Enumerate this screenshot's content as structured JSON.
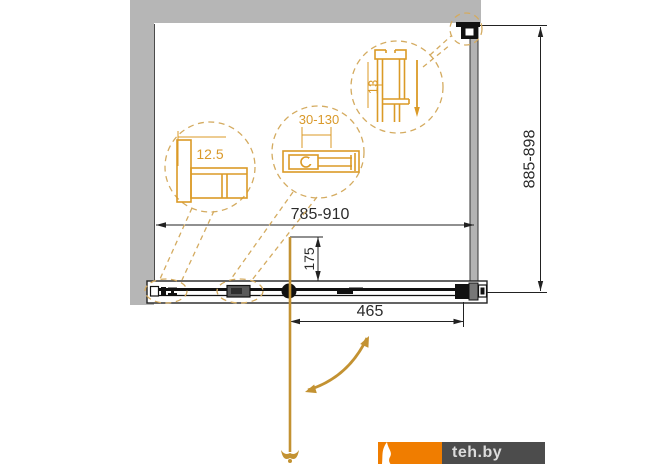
{
  "diagram": {
    "type": "shower-door-technical-drawing",
    "dimensions": {
      "width_range": "785-910",
      "height_range": "885-898",
      "door_panel_width": "465",
      "handle_offset": "175"
    },
    "details": {
      "wall_profile": "12.5",
      "adjustment_range": "30-130",
      "frame_profile": "13"
    },
    "colors": {
      "wall_gray": "#b6b6b6",
      "line_black": "#222222",
      "detail_orange": "#db9a26",
      "dashed_orange": "#d4ab60",
      "axis_gold": "#c39232"
    }
  },
  "watermark": {
    "label": "teh.by",
    "brand_orange": "#f07d00",
    "brand_dark": "#4c4c4c"
  }
}
